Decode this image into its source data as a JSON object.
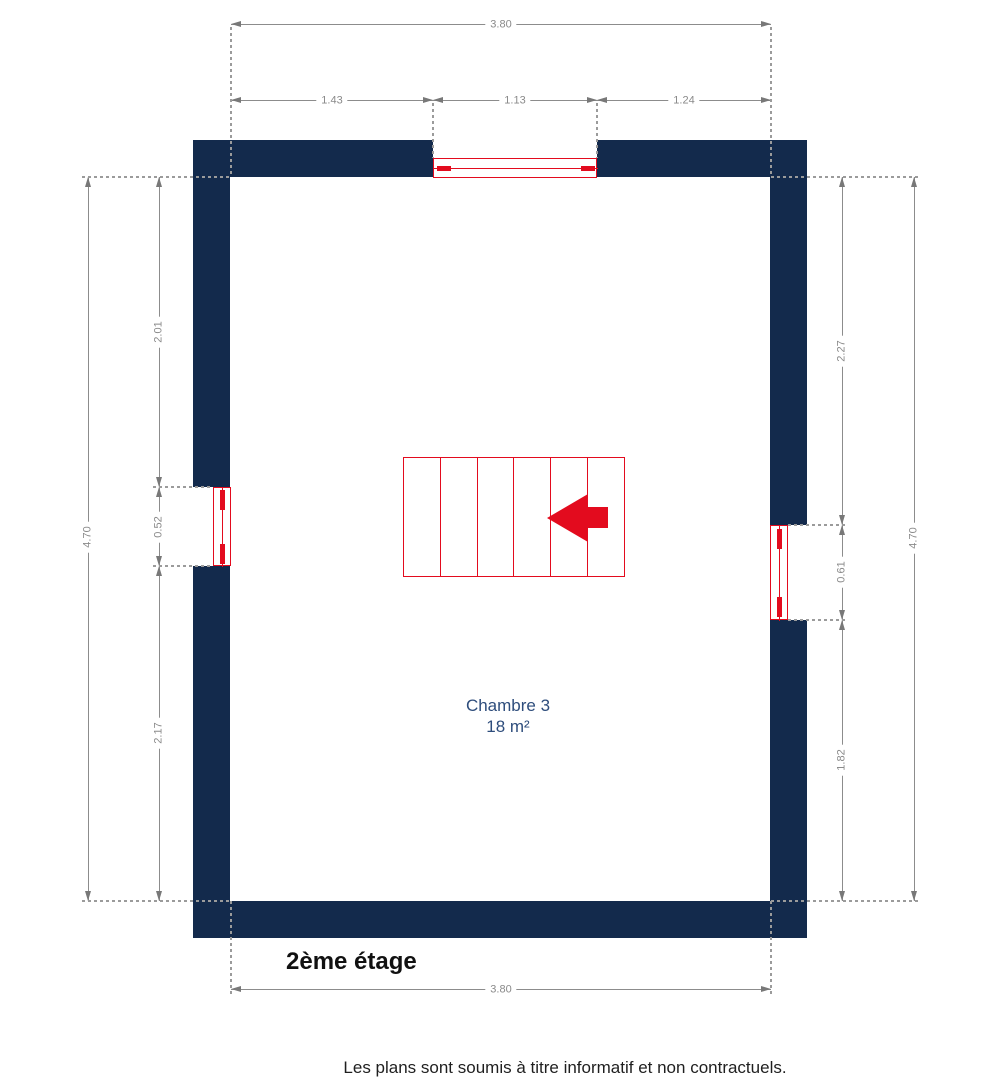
{
  "floor_plan": {
    "floor_label": "2ème étage",
    "room": {
      "name": "Chambre 3",
      "area": "18 m²"
    },
    "disclaimer": "Les plans sont soumis à titre informatif et non contractuels.",
    "dimensions": {
      "top": {
        "overall": "3.80",
        "segments": [
          "1.43",
          "1.13",
          "1.24"
        ]
      },
      "bottom": {
        "overall": "3.80"
      },
      "left": {
        "overall": "4.70",
        "segments": [
          "2.01",
          "0.52",
          "2.17"
        ]
      },
      "right": {
        "overall": "4.70",
        "segments": [
          "2.27",
          "0.61",
          "1.82"
        ]
      }
    },
    "stairs": {
      "treads": 6,
      "direction_icon": "arrow-left"
    },
    "colors": {
      "wall": "#132A4C",
      "window": "#E30B1E",
      "stairs": "#E30B1E",
      "dimension_lines": "#8C8C8C",
      "dimension_text": "#8A8A8A",
      "room_label": "#2E4D7C",
      "text": "#111111"
    }
  }
}
